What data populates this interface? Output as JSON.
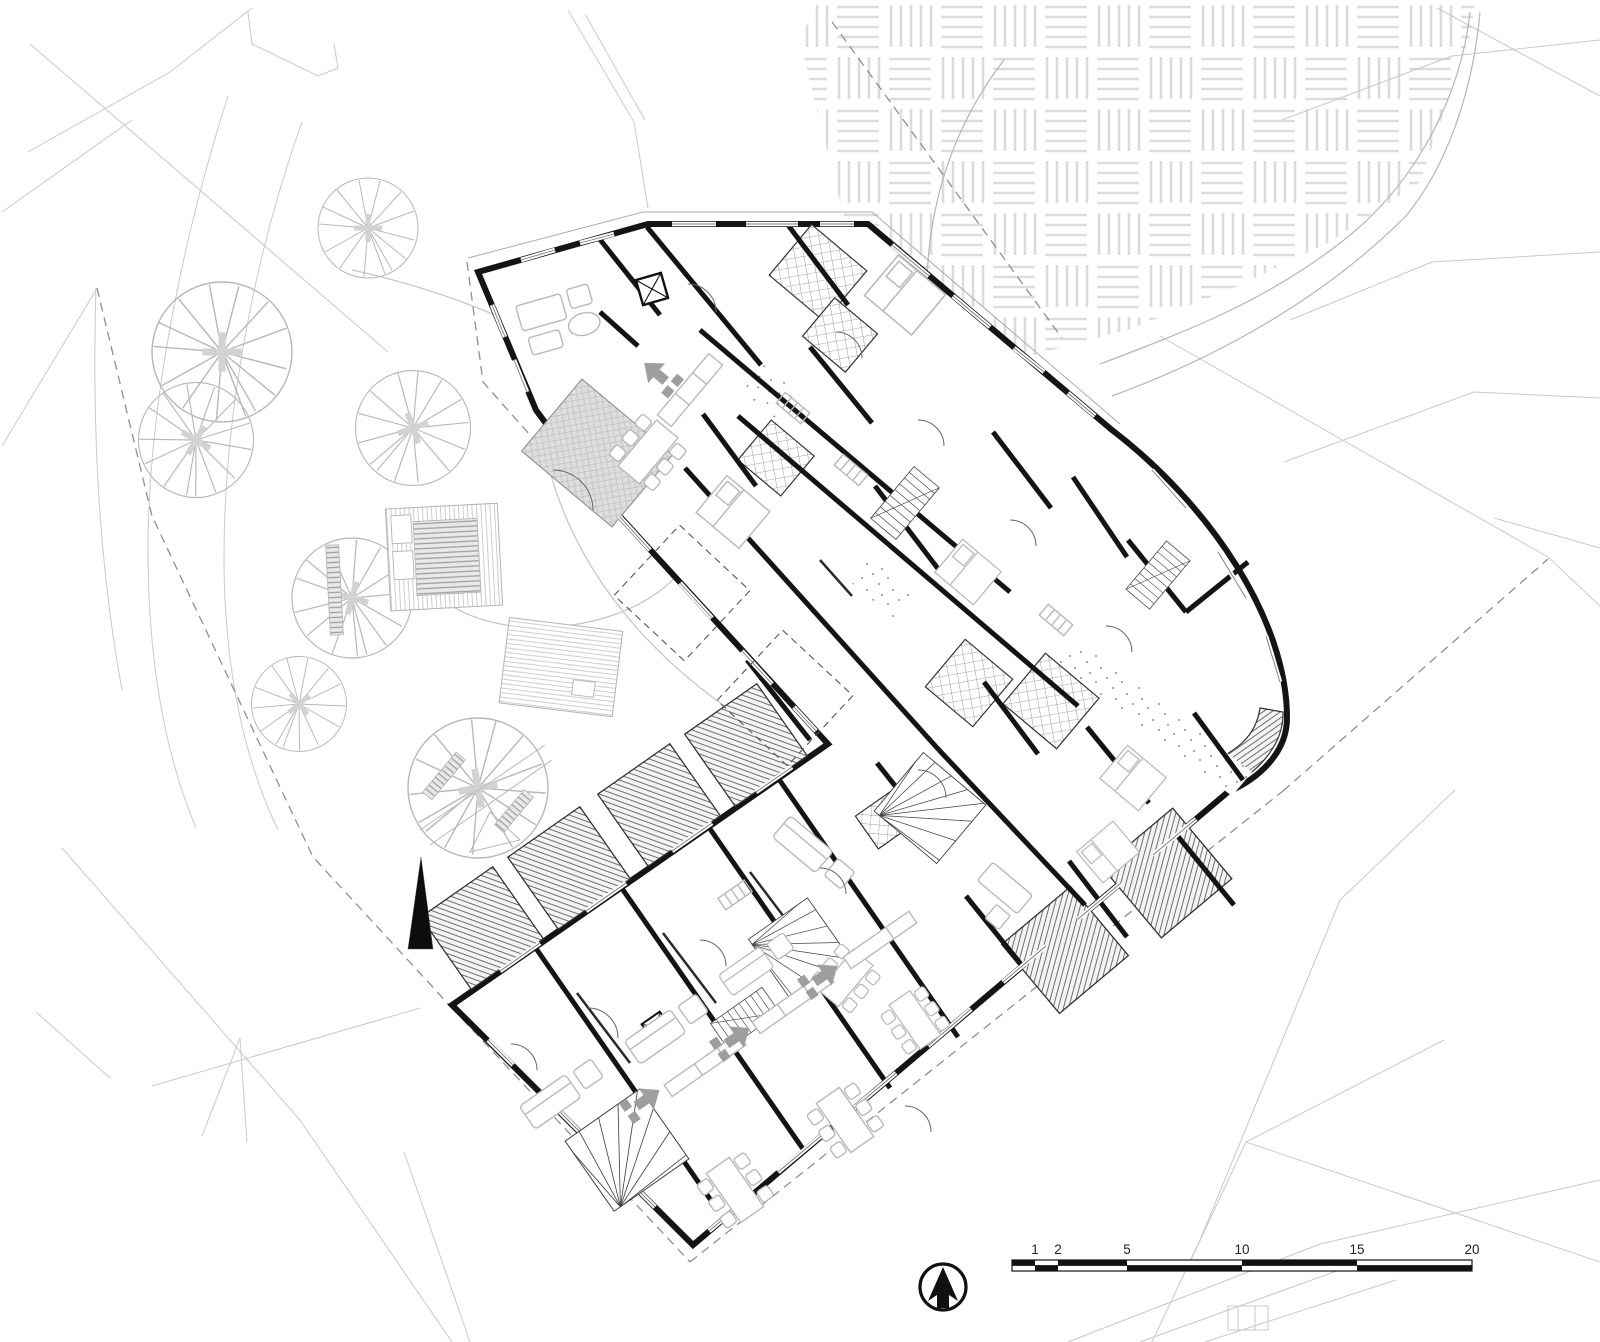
{
  "document": {
    "kind": "architectural site and ground-floor plan",
    "style": "black and white CAD drawing",
    "orientation": "north-up"
  },
  "scale_bar": {
    "unit_labels": [
      "1",
      "2",
      "5",
      "10",
      "15",
      "20"
    ],
    "unit": "m",
    "total_length_units": 20,
    "style": "alternating black-white checker bar"
  },
  "north_arrow": {
    "glyph": "arrow-up-in-circle",
    "direction": "up"
  },
  "site": {
    "ground_pattern": "basketweave-paving",
    "boundary_line_style": "dashed",
    "tree_count": 7,
    "existing_building_count": 2,
    "contour_color": "#c9c9c9",
    "boundary_color": "#8f8f8f",
    "paving_color": "#dcdcdc",
    "marker": "solid-black-spire-triangle"
  },
  "building": {
    "wings": 3,
    "wall_color": "#141414",
    "furniture_color": "#b9b9b9",
    "terrace_hatch_color": "#6e6e6e",
    "bathroom_tile_pattern": "checker-grid",
    "corridor_texture": "stipple-dots",
    "stair_count": 6,
    "terrace_count": 7,
    "balcony_count": 3
  }
}
